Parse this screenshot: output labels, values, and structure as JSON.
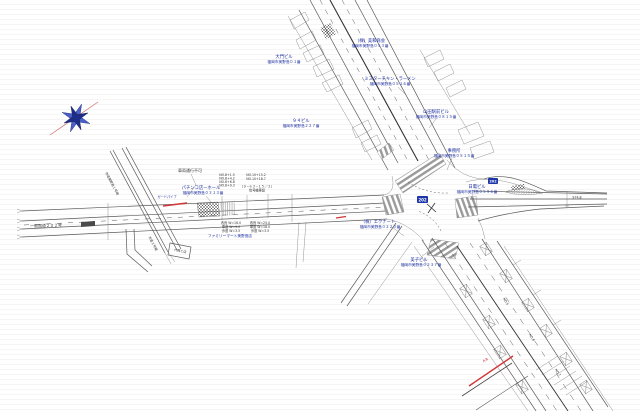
{
  "drawing_type": "road-improvement-plan",
  "colors": {
    "label_blue": "#1b2fa0",
    "line_gray": "#5a5a5a",
    "guard_red": "#cf3535",
    "shield_blue": "#1b35a8"
  },
  "labels": {
    "buildings": [
      {
        "name": "（株）美和商会",
        "addr": "福岡市美野島０５３番"
      },
      {
        "name": "大門ビル",
        "addr": "福岡市美野島０１番"
      },
      {
        "name": "ミスターチキン・ラーメン",
        "addr": "福岡市美野島０５１６番"
      },
      {
        "name": "山田駅前ビル",
        "addr": "福岡市美野島０８１５番"
      },
      {
        "name": "９４ビル",
        "addr": "福岡市美野島２２７番"
      },
      {
        "name": "事務所",
        "addr": "福岡市美野島０５１５番"
      },
      {
        "name": "日電ビル",
        "addr": "福岡市美野島０５９６番"
      },
      {
        "name": "パチンコ店ーホール",
        "addr": "福岡市美野島０３１３番"
      },
      {
        "name": "（株）エクナート",
        "addr": "福岡市美野島０２２３番"
      },
      {
        "name": "美子ビル",
        "addr": "福岡市美野島０２３７番"
      }
    ],
    "shop": "ファミリーマート美野島店",
    "guard_pipe": "ガードパイプ"
  },
  "annotations": {
    "no_entry": "車両通行不可",
    "stations_a": [
      "NO.8+1.5",
      "NO.8+4.2",
      "NO.8+6.8",
      "NO.8+9.3"
    ],
    "stations_b": [
      "NO.10+15.2",
      "NO.10+18.7"
    ],
    "signal": [
      "（９−６３−１５／２）",
      "信号機移設"
    ],
    "widths_a": [
      "改良 W=16.0",
      "車道 W=9.0",
      "歩道 W=3.5"
    ],
    "widths_b": [
      "改良 W=25.0",
      "車道 W=18.0",
      "歩道 W=3.5"
    ],
    "route_left": "一般国道２０２号",
    "dim_right": "974.8",
    "street_1": "市道美野島１号線",
    "street_2": "市道２号線",
    "bldg_box": "六興Ｃ店",
    "ab_mark": "A.B",
    "stations_road": [
      "NO.5",
      "NO.6",
      "NO.7"
    ],
    "shield": "202"
  }
}
